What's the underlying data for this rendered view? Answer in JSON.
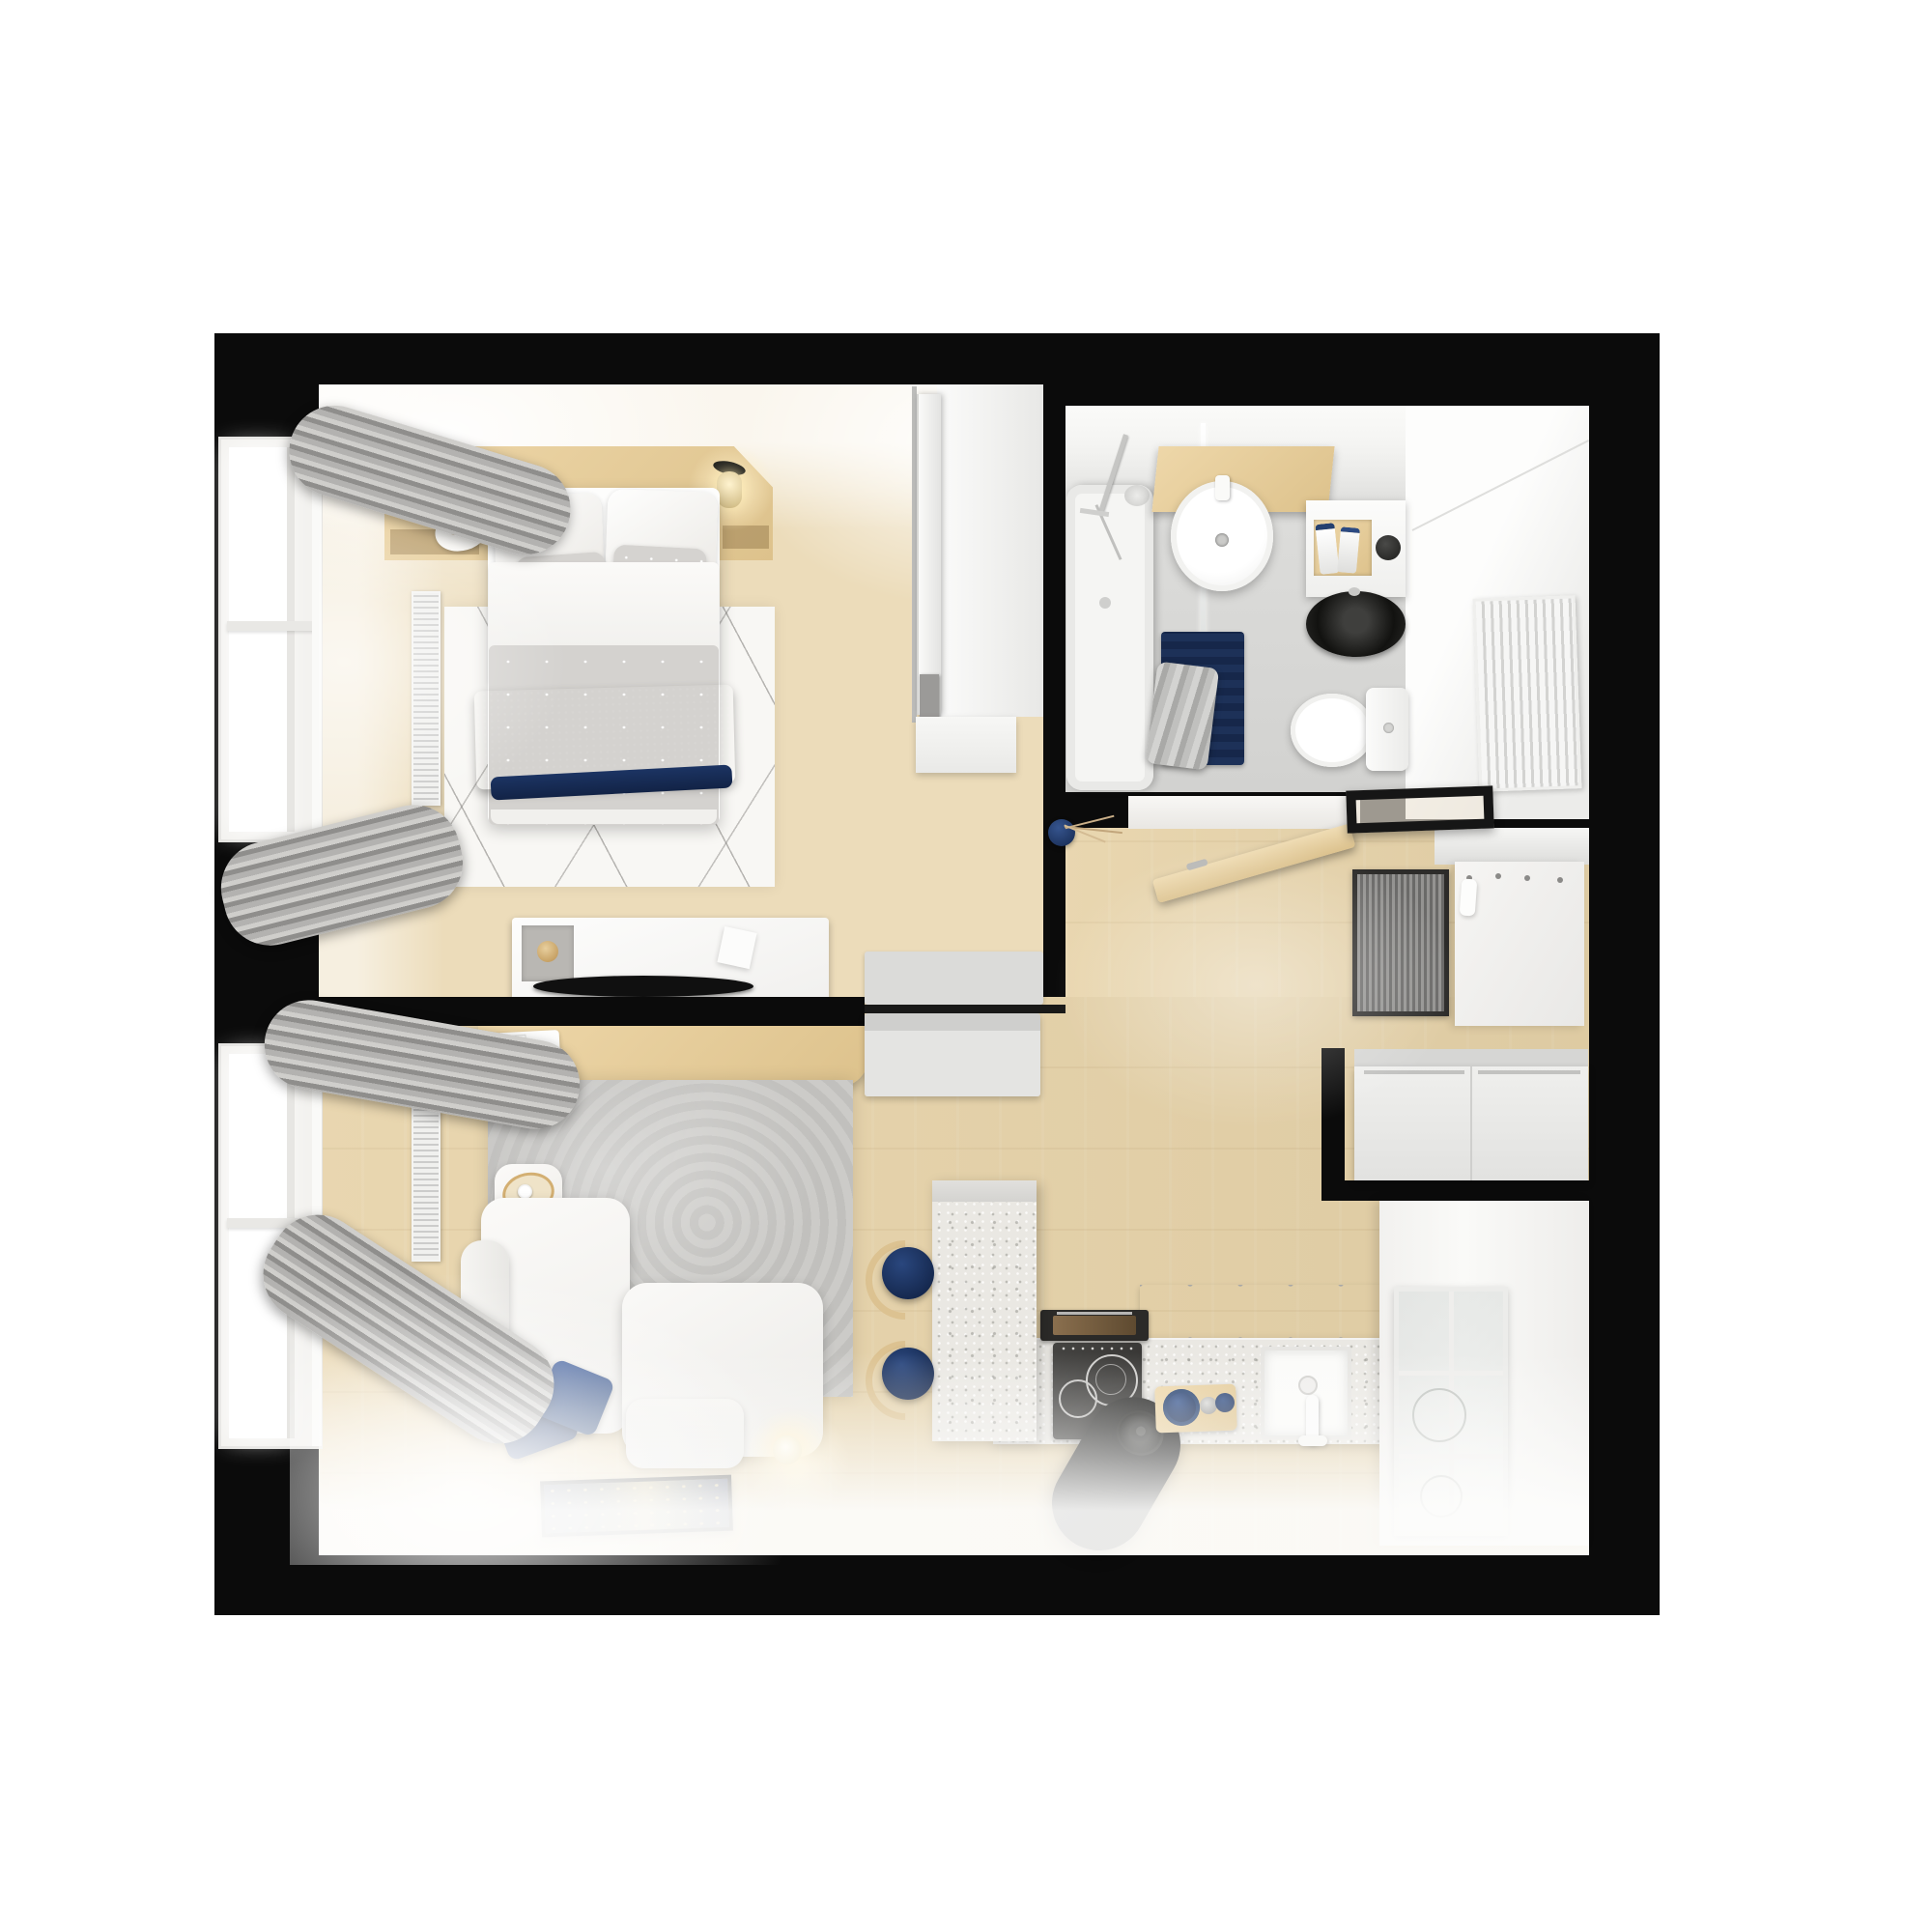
{
  "meta": {
    "kind": "3d-rendered-floor-plan",
    "view": "top-down",
    "style": "scandinavian-white-wood-navy"
  },
  "palette": {
    "page_bg": "#ffffff",
    "wall": "#0b0b0b",
    "wood_floor_a": "#ecdcba",
    "wood_floor_b": "#e7d3a9",
    "wood_furn_a": "#eed7a9",
    "wood_furn_b": "#ddc28c",
    "navy_deep": "#1b3260",
    "navy_mid": "#2c4a82",
    "terrazzo_base": "#eae8e3",
    "tile": "#d5d5d3",
    "curtain_a": "#cfcecb",
    "curtain_b": "#8f8e8c",
    "curtain_c": "#b3b2b0",
    "gray_bench": "#dbdbd9",
    "rug_living": "#c9c8c5",
    "rug_bedroom": "#f8f7f4",
    "doormat": "#797876",
    "glow": "#fff6e0"
  },
  "rooms": [
    {
      "name": "bedroom",
      "items": [
        "double-bed",
        "white-pillows",
        "gray-dotted-pillows",
        "navy-throw-blanket",
        "wood-headboard-shelf",
        "two-glass-wall-lamps",
        "bedside-tray",
        "white-line-pattern-rug",
        "dresser-with-tv",
        "felt-tray",
        "window-with-gray-curtains",
        "radiator",
        "sliding-door-closet",
        "gray-bench"
      ]
    },
    {
      "name": "bathroom",
      "items": [
        "bathtub",
        "hand-shower-set",
        "glass-partition",
        "round-washbasin",
        "wood-shelf",
        "washing-machine",
        "detergent-tray",
        "toilet",
        "navy-bath-mat",
        "gray-towel"
      ]
    },
    {
      "name": "hallway",
      "items": [
        "open-entry-door",
        "black-frame-ceiling-light",
        "striped-doormat",
        "coat-rack-panel-with-hooks",
        "shoe-bench",
        "navy-vase-with-branches",
        "niche-radiator"
      ]
    },
    {
      "name": "kitchen",
      "items": [
        "terrazzo-counter",
        "terrazzo-peninsula",
        "two-navy-bar-stools",
        "induction-cooktop",
        "built-in-oven",
        "black-cylinder-hood",
        "square-sink",
        "white-faucet",
        "cutting-board-with-navy-bowls",
        "upper-cabinets",
        "glass-display-cabinet",
        "tall-white-cabinets"
      ]
    },
    {
      "name": "living-room",
      "items": [
        "white-modular-sofa",
        "two-navy-cushions",
        "gray-rug",
        "round-side-table-with-gold-tray",
        "wood-console-desk",
        "console-tray-with-book",
        "floor-art-frame",
        "glowing-sphere-lamp",
        "window-with-gray-curtains",
        "radiator"
      ]
    }
  ]
}
